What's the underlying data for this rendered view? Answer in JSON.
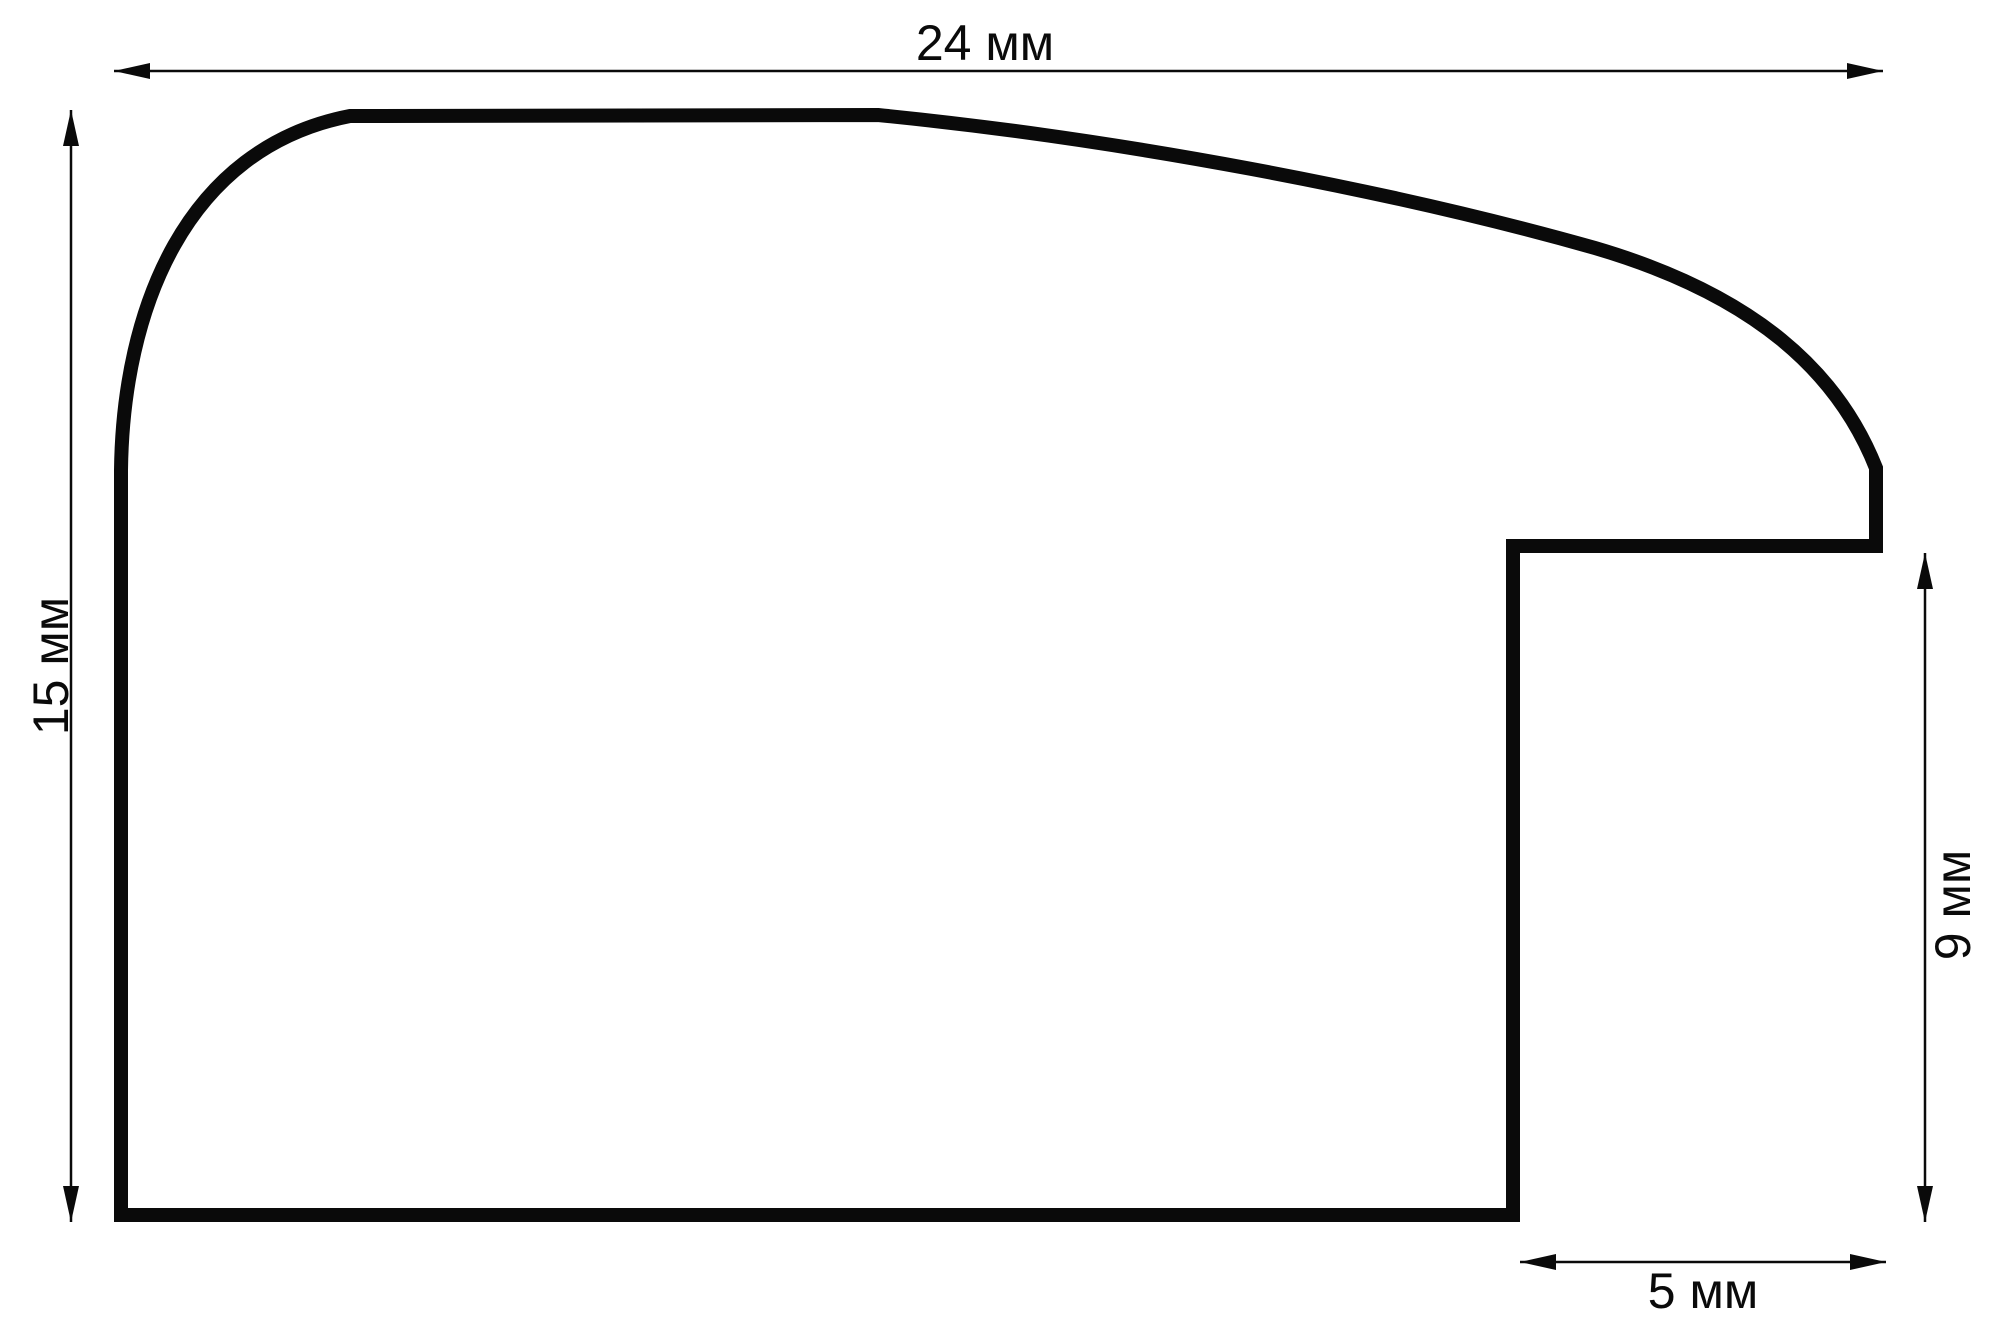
{
  "page": {
    "background": "#ffffff"
  },
  "diagram": {
    "unit": "мм",
    "stroke_color": "#0a0a0a",
    "dimensions": {
      "width": {
        "label": "24 мм",
        "value": 24
      },
      "height": {
        "label": "15 мм",
        "value": 15
      },
      "rabbet_height": {
        "label": "9 мм",
        "value": 9
      },
      "rabbet_width": {
        "label": "5 мм",
        "value": 5
      }
    }
  }
}
